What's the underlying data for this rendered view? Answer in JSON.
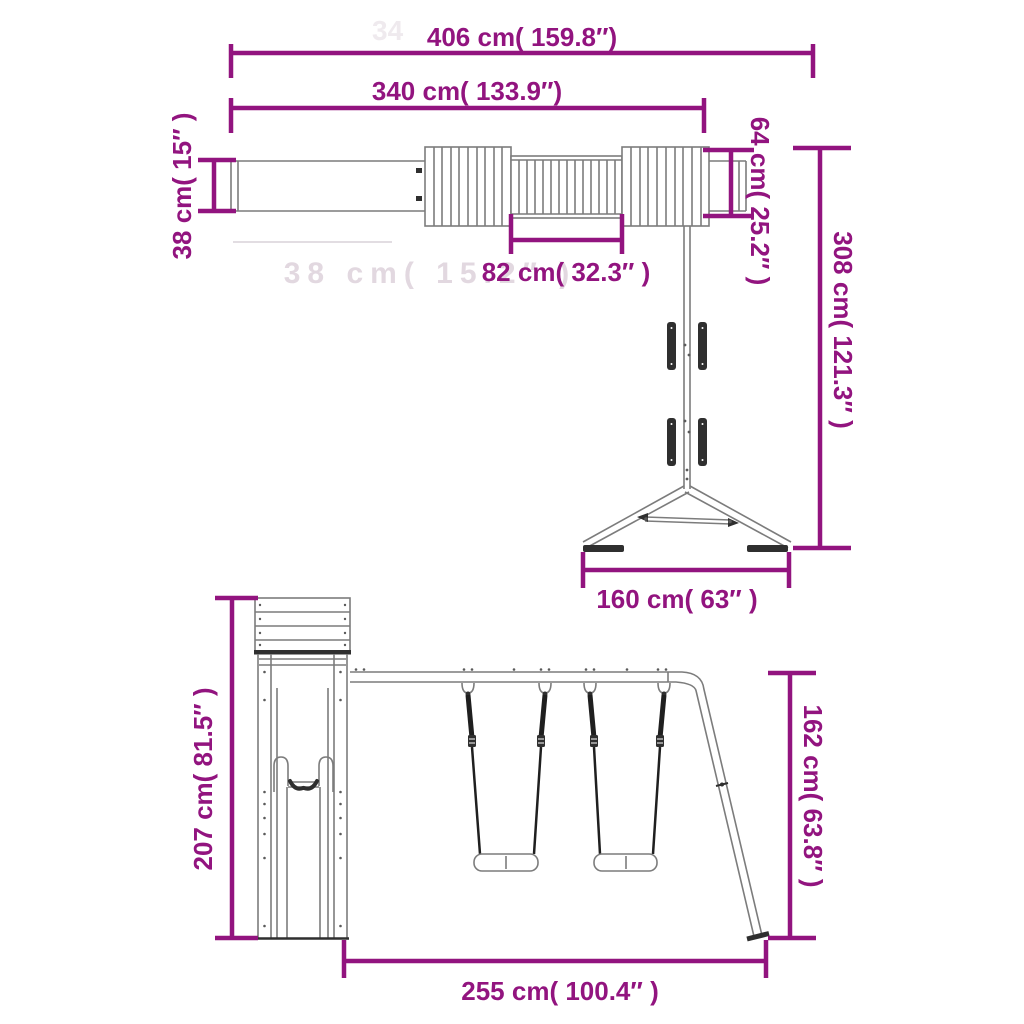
{
  "page": {
    "kind": "product-dimension-diagram",
    "views": [
      "side-elevation-monkey-bar-with-a-frame",
      "front-elevation-tower-slide-and-double-swing"
    ]
  },
  "colors": {
    "dimension": "#92147F",
    "structure": "#7c7c7c",
    "structure_dark": "#2f2f2f",
    "rope": "#1f1f1f",
    "background": "#ffffff",
    "watermark": "#e2d8e0",
    "watermark_light": "#efeaee"
  },
  "top_view": {
    "overall_width": "406 cm( 159.8″)",
    "beam_length": "340 cm( 133.9″)",
    "mid_section": "82 cm( 32.3″ )",
    "end_height": "38 cm( 15″ )",
    "beam_height": "64 cm( 25.2″ )",
    "overall_height": "308 cm( 121.3″ )",
    "base_width": "160 cm( 63″ )"
  },
  "front_view": {
    "tower_height": "207 cm( 81.5″ )",
    "frame_height": "162 cm( 63.8″ )",
    "base_width": "255 cm( 100.4″ )"
  },
  "watermarks": {
    "top": "34",
    "middle": "38 cm( 15.2″ )"
  }
}
